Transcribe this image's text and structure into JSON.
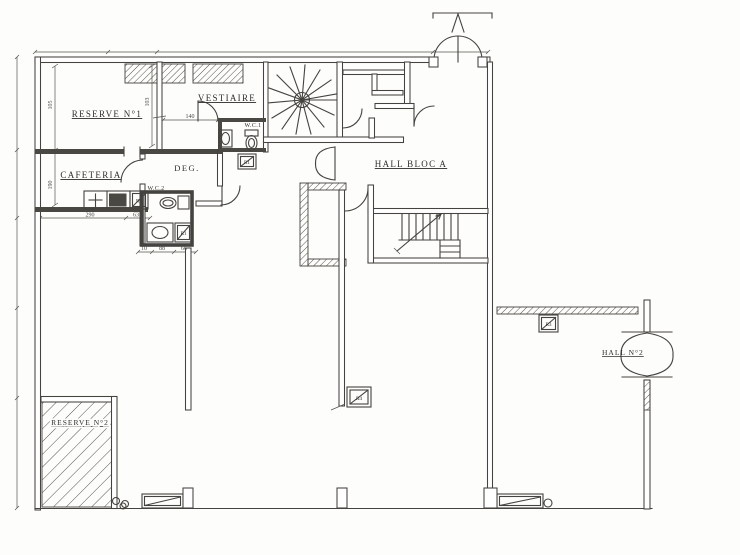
{
  "palette": {
    "paper": "#fdfdfb",
    "ink": "#45433f"
  },
  "rooms": [
    {
      "id": "reserve-1",
      "label": "RESERVE N°1"
    },
    {
      "id": "vestiaire",
      "label": "VESTIAIRE"
    },
    {
      "id": "cafeteria",
      "label": "CAFETERIA"
    },
    {
      "id": "degagement",
      "label": "DEG."
    },
    {
      "id": "wc-1",
      "label": "W.C.1"
    },
    {
      "id": "wc-2",
      "label": "W.C.2"
    },
    {
      "id": "hall-bloc-a",
      "label": "HALL BLOC A"
    },
    {
      "id": "hall-2",
      "label": "HALL N°2"
    },
    {
      "id": "reserve-2",
      "label": "RESERVE N°2"
    }
  ],
  "radiators": [
    {
      "id": "rad-wc1",
      "label": "R1"
    },
    {
      "id": "rad-cafeteria",
      "label": "R2"
    },
    {
      "id": "rad-wc2",
      "label": "R1"
    },
    {
      "id": "rad-hall2",
      "label": "R3"
    },
    {
      "id": "rad-partition",
      "label": "R4"
    }
  ],
  "dimensions": [
    {
      "id": "dim-reserve1-height",
      "value": "105"
    },
    {
      "id": "dim-cafeteria-height",
      "value": "190"
    },
    {
      "id": "dim-reserve1-width",
      "value": "103"
    },
    {
      "id": "dim-vestiaire-width",
      "value": "140"
    },
    {
      "id": "dim-cafeteria-width",
      "value": "290"
    },
    {
      "id": "dim-door",
      "value": "63"
    },
    {
      "id": "dim-wc2-a",
      "value": "10"
    },
    {
      "id": "dim-wc2-b",
      "value": "88"
    },
    {
      "id": "dim-wc2-c",
      "value": "66"
    }
  ]
}
